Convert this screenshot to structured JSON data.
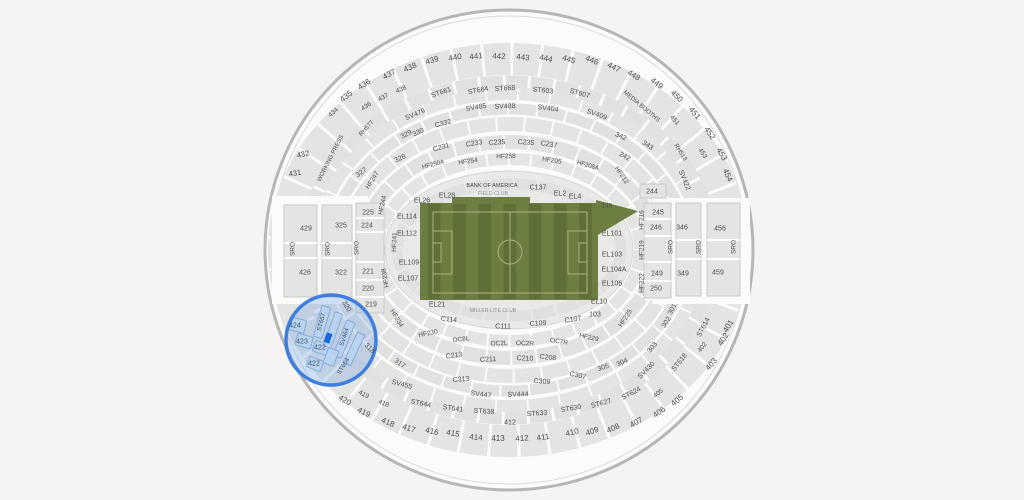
{
  "page": {
    "background": "#f5f4f2"
  },
  "map": {
    "center": [
      509,
      250
    ],
    "shellFill": "#fbfbfa",
    "secFill": "#e4e4e3",
    "secStroke": "#c9c9c8",
    "textColors": [
      "#4c4c4c",
      "#3d4f66",
      "#90908a"
    ],
    "shell": [
      {
        "rx": 244,
        "ry": 240,
        "fill": "#fbfbfa",
        "stroke": "#b6b6b4",
        "sw": 3
      },
      {
        "rx": 238,
        "ry": 234,
        "fill": "none",
        "stroke": "#dadad8",
        "sw": 1
      }
    ],
    "rings": [
      {
        "rx": 225,
        "ry": 191,
        "w": 32,
        "c": "#e4e4e2",
        "d": "26 3"
      },
      {
        "rx": 204,
        "ry": 168,
        "w": 13,
        "c": "#e1e1df",
        "d": "22 3"
      },
      {
        "rx": 192,
        "ry": 156,
        "w": 12,
        "c": "#e4e4e2",
        "d": "30 2"
      },
      {
        "rx": 178,
        "ry": 141,
        "w": 11,
        "c": "#e1e1df",
        "d": "27 2"
      },
      {
        "rx": 163,
        "ry": 126,
        "w": 14,
        "c": "#e4e4e2",
        "d": "26 2"
      },
      {
        "rx": 147,
        "ry": 108,
        "w": 14,
        "c": "#e1e1df",
        "d": "23 2"
      },
      {
        "rx": 131,
        "ry": 91,
        "w": 12,
        "c": "#e4e4e2",
        "d": "20 2"
      }
    ],
    "innerRings": [
      {
        "rx": 112,
        "ry": 66,
        "w": 11,
        "c": "#e0e0de",
        "d": "22 2"
      }
    ],
    "erasers": [
      [
        272,
        196,
        96,
        108
      ],
      [
        652,
        198,
        98,
        106
      ]
    ],
    "bowl": {
      "rx": 124,
      "ry": 79,
      "fill": "#e9e9e7",
      "stroke": "#d6d6d4"
    },
    "field": {
      "fill": "#6d7e42",
      "stripe": "#5e7038",
      "base": [
        420,
        203,
        178,
        97
      ],
      "bump": [
        452,
        197,
        78,
        7
      ],
      "point": "596,200 638,211 596,236",
      "stripes": {
        "x0": 428,
        "w": 12.6,
        "n": 13,
        "y": 204,
        "h": 95
      },
      "lineColor": "#a9b47f",
      "boundary": [
        433,
        212,
        154,
        81
      ],
      "mid": [
        510,
        212,
        510,
        293
      ],
      "centerCircle": [
        510,
        252,
        12
      ],
      "boxes": [
        [
          433,
          231,
          19,
          43
        ],
        [
          568,
          231,
          19,
          43
        ],
        [
          433,
          243,
          8,
          19
        ],
        [
          579,
          243,
          8,
          19
        ]
      ]
    },
    "blocks": [
      {
        "x": 284,
        "y": 205,
        "w": 33,
        "h": 92,
        "divs": [
          243,
          258
        ]
      },
      {
        "x": 322,
        "y": 205,
        "w": 30,
        "h": 92,
        "divs": [
          243,
          258
        ]
      },
      {
        "x": 356,
        "y": 203,
        "w": 28,
        "h": 110,
        "divs": [
          218,
          232,
          262,
          280,
          297
        ]
      },
      {
        "x": 640,
        "y": 184,
        "w": 26,
        "h": 14,
        "divs": []
      },
      {
        "x": 644,
        "y": 203,
        "w": 27,
        "h": 95,
        "divs": [
          219,
          236,
          262,
          281
        ]
      },
      {
        "x": 676,
        "y": 203,
        "w": 25,
        "h": 93,
        "divs": [
          240,
          259
        ]
      },
      {
        "x": 707,
        "y": 203,
        "w": 33,
        "h": 93,
        "divs": [
          240,
          259
        ]
      }
    ],
    "highlight": {
      "cx": 331,
      "cy": 340,
      "r": 45,
      "fill": "rgba(124,169,226,0.34)",
      "stroke": "#3c7fdf",
      "sw": 3.5,
      "secFill": "#b9d2ef",
      "secStroke": "#84abdc",
      "sections": [
        [
          297,
          325,
          17,
          13,
          14
        ],
        [
          304,
          341,
          16,
          12,
          17
        ],
        [
          321,
          348,
          15,
          11,
          19
        ],
        [
          315,
          364,
          15,
          11,
          21
        ],
        [
          322,
          322,
          9,
          32,
          16
        ],
        [
          333,
          330,
          8,
          36,
          19
        ],
        [
          344,
          339,
          9,
          38,
          22
        ],
        [
          354,
          349,
          8,
          34,
          25
        ],
        [
          331,
          357,
          11,
          16,
          21
        ]
      ],
      "marker": [
        328,
        338,
        6,
        10,
        19
      ],
      "markerFill": "#1b67de"
    },
    "labels": [
      [
        "435",
        346,
        96,
        -38,
        8
      ],
      [
        "436",
        364,
        84,
        -33,
        8
      ],
      [
        "437",
        389,
        74,
        -28,
        8
      ],
      [
        "438",
        410,
        67,
        -23,
        8
      ],
      [
        "439",
        432,
        60,
        -17,
        8
      ],
      [
        "440",
        455,
        57,
        -11,
        8
      ],
      [
        "441",
        476,
        56,
        -6,
        8
      ],
      [
        "442",
        499,
        56,
        2,
        8
      ],
      [
        "443",
        523,
        57,
        7,
        8
      ],
      [
        "444",
        546,
        58,
        12,
        8
      ],
      [
        "445",
        569,
        59,
        17,
        8
      ],
      [
        "446",
        592,
        60,
        22,
        8
      ],
      [
        "447",
        614,
        67,
        27,
        8
      ],
      [
        "448",
        634,
        75,
        32,
        8
      ],
      [
        "449",
        657,
        83,
        38,
        8
      ],
      [
        "450",
        677,
        96,
        44,
        8
      ],
      [
        "451",
        695,
        113,
        50,
        8
      ],
      [
        "452",
        710,
        133,
        55,
        8
      ],
      [
        "453",
        722,
        154,
        60,
        8
      ],
      [
        "454",
        728,
        175,
        66,
        8
      ],
      [
        "434",
        333,
        112,
        -42,
        6.5
      ],
      [
        "436",
        366,
        106,
        -33,
        6.5
      ],
      [
        "437",
        383,
        97,
        -28,
        6.5
      ],
      [
        "438",
        401,
        89,
        -23,
        6.5
      ],
      [
        "451",
        675,
        120,
        48,
        6.5
      ],
      [
        "453",
        703,
        153,
        57,
        6.5
      ],
      [
        "432",
        303,
        154,
        -12,
        7.5
      ],
      [
        "431",
        295,
        173,
        -8,
        7.5
      ],
      [
        "420",
        345,
        400,
        30,
        8
      ],
      [
        "419",
        364,
        412,
        27,
        8
      ],
      [
        "418",
        388,
        422,
        23,
        8
      ],
      [
        "417",
        409,
        428,
        18,
        8
      ],
      [
        "416",
        432,
        431,
        13,
        8
      ],
      [
        "415",
        453,
        433,
        9,
        8
      ],
      [
        "414",
        476,
        437,
        5,
        8
      ],
      [
        "413",
        498,
        438,
        0,
        8
      ],
      [
        "412",
        522,
        438,
        -4,
        8
      ],
      [
        "411",
        543,
        437,
        -8,
        8
      ],
      [
        "410",
        572,
        432,
        -14,
        8
      ],
      [
        "409",
        592,
        431,
        -19,
        8
      ],
      [
        "408",
        613,
        428,
        -24,
        8
      ],
      [
        "407",
        636,
        422,
        -30,
        8
      ],
      [
        "406",
        659,
        412,
        -35,
        8
      ],
      [
        "405",
        677,
        400,
        -40,
        8
      ],
      [
        "403",
        711,
        364,
        -50,
        8
      ],
      [
        "402",
        723,
        339,
        -55,
        8
      ],
      [
        "401",
        728,
        326,
        -58,
        8
      ],
      [
        "419",
        364,
        394,
        27,
        6.5
      ],
      [
        "418",
        384,
        403,
        23,
        6.5
      ],
      [
        "405",
        658,
        393,
        -38,
        6.5
      ],
      [
        "402",
        702,
        347,
        -52,
        6.5
      ],
      [
        "412",
        510,
        422,
        0,
        7
      ],
      [
        "301",
        672,
        309,
        -62
      ],
      [
        "302",
        666,
        322,
        -58
      ],
      [
        "303",
        652,
        347,
        -50
      ],
      [
        "304",
        622,
        362,
        -25
      ],
      [
        "305",
        603,
        367,
        -18
      ],
      [
        "317",
        400,
        363,
        35
      ],
      [
        "318",
        370,
        348,
        45
      ],
      [
        "320",
        347,
        306,
        60
      ],
      [
        "ST661",
        441,
        92,
        -20
      ],
      [
        "ST664",
        478,
        90,
        -11
      ],
      [
        "ST668",
        505,
        88,
        -3
      ],
      [
        "ST603",
        543,
        90,
        6
      ],
      [
        "ST607",
        580,
        93,
        15
      ],
      [
        "ST644",
        421,
        403,
        12
      ],
      [
        "ST641",
        453,
        408,
        8
      ],
      [
        "ST638",
        484,
        411,
        4
      ],
      [
        "ST633",
        537,
        413,
        -4
      ],
      [
        "ST630",
        571,
        408,
        -10
      ],
      [
        "ST627",
        601,
        403,
        -15
      ],
      [
        "ST624",
        631,
        393,
        -28
      ],
      [
        "ST618",
        679,
        362,
        -52
      ],
      [
        "ST614",
        703,
        327,
        -62
      ],
      [
        "SV479",
        415,
        114,
        -22
      ],
      [
        "SV485",
        476,
        107,
        -10
      ],
      [
        "SV488",
        505,
        106,
        -2
      ],
      [
        "SV404",
        548,
        108,
        8
      ],
      [
        "SV409",
        597,
        114,
        20
      ],
      [
        "SV422",
        685,
        180,
        68
      ],
      [
        "SV455",
        402,
        384,
        15
      ],
      [
        "SV447",
        481,
        394,
        7
      ],
      [
        "SV444",
        518,
        394,
        -2
      ],
      [
        "SV430",
        646,
        370,
        -45
      ],
      [
        "RH577",
        366,
        128,
        -48,
        6
      ],
      [
        "RH518",
        681,
        152,
        58,
        6
      ],
      [
        "MEDIA BOOTHS",
        642,
        106,
        40,
        6
      ],
      [
        "WORKING PRESS",
        330,
        158,
        -63,
        6
      ],
      [
        "C332",
        443,
        123,
        -15
      ],
      [
        "330",
        418,
        132,
        -25
      ],
      [
        "329",
        406,
        134,
        -28
      ],
      [
        "342",
        621,
        136,
        25
      ],
      [
        "343",
        648,
        145,
        33
      ],
      [
        "C313",
        461,
        379,
        -6
      ],
      [
        "C309",
        542,
        381,
        4
      ],
      [
        "C307",
        578,
        375,
        12
      ],
      [
        "C231",
        441,
        147,
        -16
      ],
      [
        "C233",
        474,
        143,
        -9
      ],
      [
        "C235",
        497,
        142,
        -3
      ],
      [
        "C235",
        526,
        142,
        4
      ],
      [
        "C237",
        549,
        144,
        10
      ],
      [
        "242",
        625,
        156,
        28
      ],
      [
        "328",
        400,
        158,
        -25
      ],
      [
        "327",
        361,
        172,
        -35
      ],
      [
        "C213",
        454,
        355,
        -8
      ],
      [
        "C211",
        488,
        359,
        -3
      ],
      [
        "C210",
        525,
        358,
        2
      ],
      [
        "C208",
        548,
        357,
        6
      ],
      [
        "HF250A",
        433,
        164,
        -14,
        6.2
      ],
      [
        "HF254",
        468,
        161,
        -8,
        6.5
      ],
      [
        "HF258",
        506,
        156,
        -1,
        6.5
      ],
      [
        "HF205",
        552,
        160,
        8,
        6.5
      ],
      [
        "HF208A",
        588,
        165,
        15,
        6.2
      ],
      [
        "HF212",
        622,
        175,
        56,
        6.5
      ],
      [
        "HF247",
        372,
        180,
        -58,
        6.5
      ],
      [
        "HF244",
        382,
        205,
        -78,
        6.5
      ],
      [
        "HF241",
        394,
        242,
        -88,
        6.5
      ],
      [
        "HF238",
        385,
        278,
        -100,
        6.5
      ],
      [
        "HF234",
        397,
        318,
        59,
        6.5
      ],
      [
        "HF230",
        428,
        333,
        -12,
        6.5
      ],
      [
        "OC8L",
        461,
        339,
        -8,
        6.5
      ],
      [
        "OC2L",
        499,
        343,
        -2,
        6.5
      ],
      [
        "OC2R",
        525,
        343,
        2,
        6.5
      ],
      [
        "OC7R",
        559,
        341,
        8,
        6.5
      ],
      [
        "HF229",
        589,
        337,
        13,
        6.5
      ],
      [
        "HF225",
        625,
        318,
        -56,
        6.5
      ],
      [
        "HF222",
        641,
        283,
        -90,
        6.5
      ],
      [
        "HF219",
        641,
        250,
        -90,
        6.5
      ],
      [
        "HF216",
        641,
        220,
        -90,
        6.5
      ],
      [
        "C137",
        538,
        187
      ],
      [
        "BANK OF AMERICA",
        492,
        185,
        0,
        5.6
      ],
      [
        "FIELD CLUB",
        493,
        193,
        0,
        5.2,
        2
      ],
      [
        "EL26",
        422,
        200
      ],
      [
        "EL28",
        447,
        195
      ],
      [
        "EL2",
        560,
        193
      ],
      [
        "EL4",
        575,
        196
      ],
      [
        "145",
        607,
        205,
        0,
        6.5
      ],
      [
        "EL114",
        407,
        216
      ],
      [
        "EL112",
        407,
        233
      ],
      [
        "EL109",
        409,
        262
      ],
      [
        "EL107",
        408,
        278
      ],
      [
        "EL21",
        437,
        304
      ],
      [
        "EL101",
        612,
        233
      ],
      [
        "EL103",
        612,
        254
      ],
      [
        "EL104A",
        614,
        269
      ],
      [
        "EL106",
        612,
        283
      ],
      [
        "EL10",
        599,
        301
      ],
      [
        "103",
        595,
        314
      ],
      [
        "MILLER LITE CLUB",
        493,
        310,
        0,
        5.2,
        2
      ],
      [
        "C114",
        449,
        319,
        6
      ],
      [
        "C111",
        503,
        326
      ],
      [
        "C109",
        538,
        323,
        -4
      ],
      [
        "C107",
        573,
        319,
        -8
      ],
      [
        "429",
        306,
        228
      ],
      [
        "426",
        305,
        272
      ],
      [
        "325",
        341,
        225
      ],
      [
        "322",
        341,
        272
      ],
      [
        "225",
        368,
        212
      ],
      [
        "224",
        367,
        225
      ],
      [
        "221",
        368,
        271
      ],
      [
        "220",
        368,
        288
      ],
      [
        "219",
        371,
        304
      ],
      [
        "SRO",
        292,
        249,
        -90,
        6.5
      ],
      [
        "SRO",
        327,
        249,
        -90,
        6.5
      ],
      [
        "SRO",
        356,
        248,
        -90,
        6.5
      ],
      [
        "244",
        652,
        191
      ],
      [
        "245",
        658,
        212
      ],
      [
        "246",
        656,
        227
      ],
      [
        "249",
        657,
        273
      ],
      [
        "250",
        656,
        288
      ],
      [
        "346",
        682,
        227
      ],
      [
        "349",
        683,
        273
      ],
      [
        "456",
        720,
        228
      ],
      [
        "459",
        718,
        272
      ],
      [
        "SRO",
        670,
        247,
        -90,
        6.5
      ],
      [
        "SRO",
        698,
        247,
        -90,
        6.5
      ],
      [
        "SRO",
        733,
        247,
        -90,
        6.5
      ],
      [
        "424",
        295,
        325,
        0,
        7,
        1
      ],
      [
        "423",
        302,
        341,
        0,
        7,
        1
      ],
      [
        "422",
        320,
        347,
        0,
        7,
        1
      ],
      [
        "422",
        314,
        363,
        0,
        7,
        1
      ],
      [
        "ST657",
        321,
        322,
        -75,
        6.2,
        1
      ],
      [
        "SV464",
        344,
        337,
        -72,
        6.2,
        1
      ],
      [
        "ST654",
        343,
        366,
        -58,
        6.2,
        1
      ]
    ]
  }
}
